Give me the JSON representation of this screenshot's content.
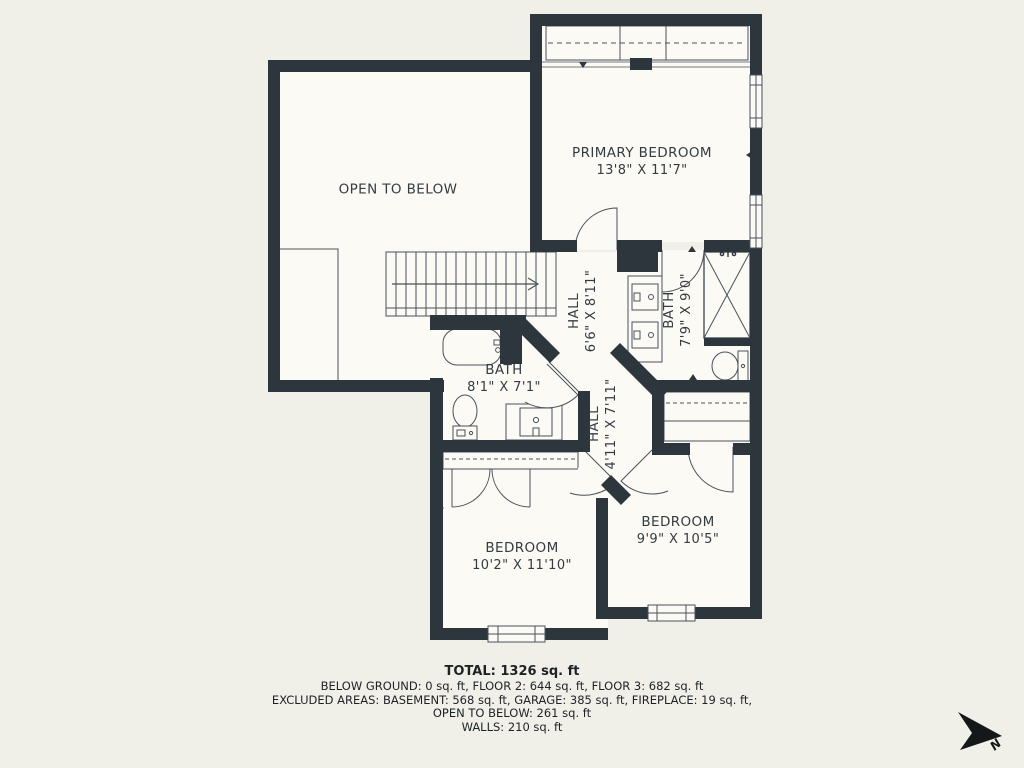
{
  "colors": {
    "wall": "#2d363c",
    "line": "#49525a",
    "text": "#343c41",
    "floor": "#fbfaf5",
    "background": "#f1f0e8"
  },
  "rooms": {
    "open_to_below": {
      "name": "OPEN TO BELOW"
    },
    "primary_bedroom": {
      "name": "PRIMARY BEDROOM",
      "dims": "13'8\" X 11'7\""
    },
    "hall_upper": {
      "name": "HALL",
      "dims": "6'6\" X 8'11\""
    },
    "bath_primary": {
      "name": "BATH",
      "dims": "7'9\" X 9'0\""
    },
    "bath_hall": {
      "name": "BATH",
      "dims": "8'1\" X 7'1\""
    },
    "hall_lower": {
      "name": "HALL",
      "dims": "4'11\" X 7'11\""
    },
    "bedroom_left": {
      "name": "BEDROOM",
      "dims": "10'2\" X 11'10\""
    },
    "bedroom_right": {
      "name": "BEDROOM",
      "dims": "9'9\" X 10'5\""
    }
  },
  "summary": {
    "total": "TOTAL: 1326 sq. ft",
    "floors": "BELOW GROUND: 0 sq. ft, FLOOR 2: 644 sq. ft, FLOOR 3: 682 sq. ft",
    "excluded": "EXCLUDED AREAS: BASEMENT: 568 sq. ft, GARAGE: 385 sq. ft, FIREPLACE: 19 sq. ft,",
    "open_to_below": "OPEN TO BELOW: 261 sq. ft",
    "walls": "WALLS: 210 sq. ft"
  },
  "compass": {
    "label": "N"
  }
}
